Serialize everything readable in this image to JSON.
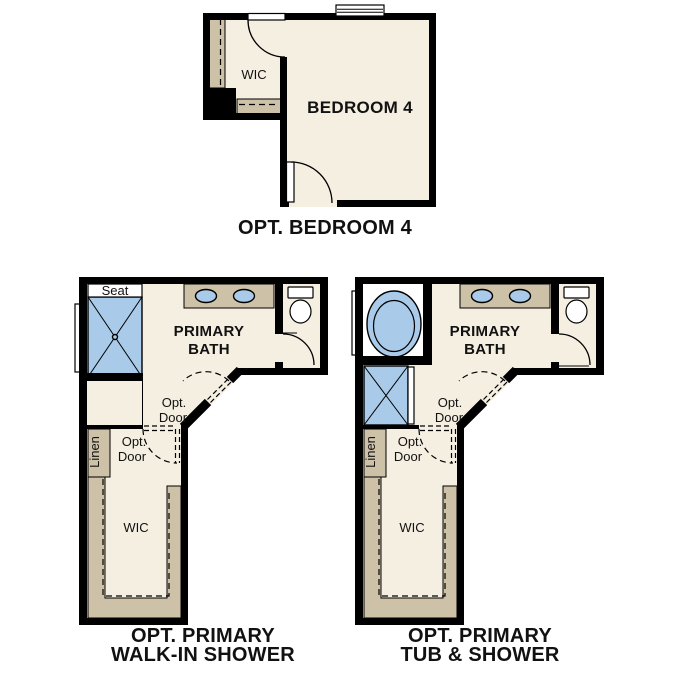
{
  "colors": {
    "wall": "#000000",
    "floor": "#f5efe2",
    "casework": "#cdc1a7",
    "fixture_blue": "#a9cae8",
    "text": "#111111"
  },
  "plans": {
    "bedroom4": {
      "caption": "OPT. BEDROOM 4",
      "room": "BEDROOM 4",
      "wic": "WIC"
    },
    "walk_in_shower": {
      "caption1": "OPT. PRIMARY",
      "caption2": "WALK-IN SHOWER",
      "bath1": "PRIMARY",
      "bath2": "BATH",
      "seat": "Seat",
      "linen": "Linen",
      "wic": "WIC",
      "opt_door_bath1": "Opt.",
      "opt_door_bath2": "Door",
      "opt_door_wic1": "Opt.",
      "opt_door_wic2": "Door"
    },
    "tub_shower": {
      "caption1": "OPT. PRIMARY",
      "caption2": "TUB & SHOWER",
      "bath1": "PRIMARY",
      "bath2": "BATH",
      "linen": "Linen",
      "wic": "WIC",
      "opt_door_bath1": "Opt.",
      "opt_door_bath2": "Door",
      "opt_door_wic1": "Opt.",
      "opt_door_wic2": "Door"
    }
  }
}
